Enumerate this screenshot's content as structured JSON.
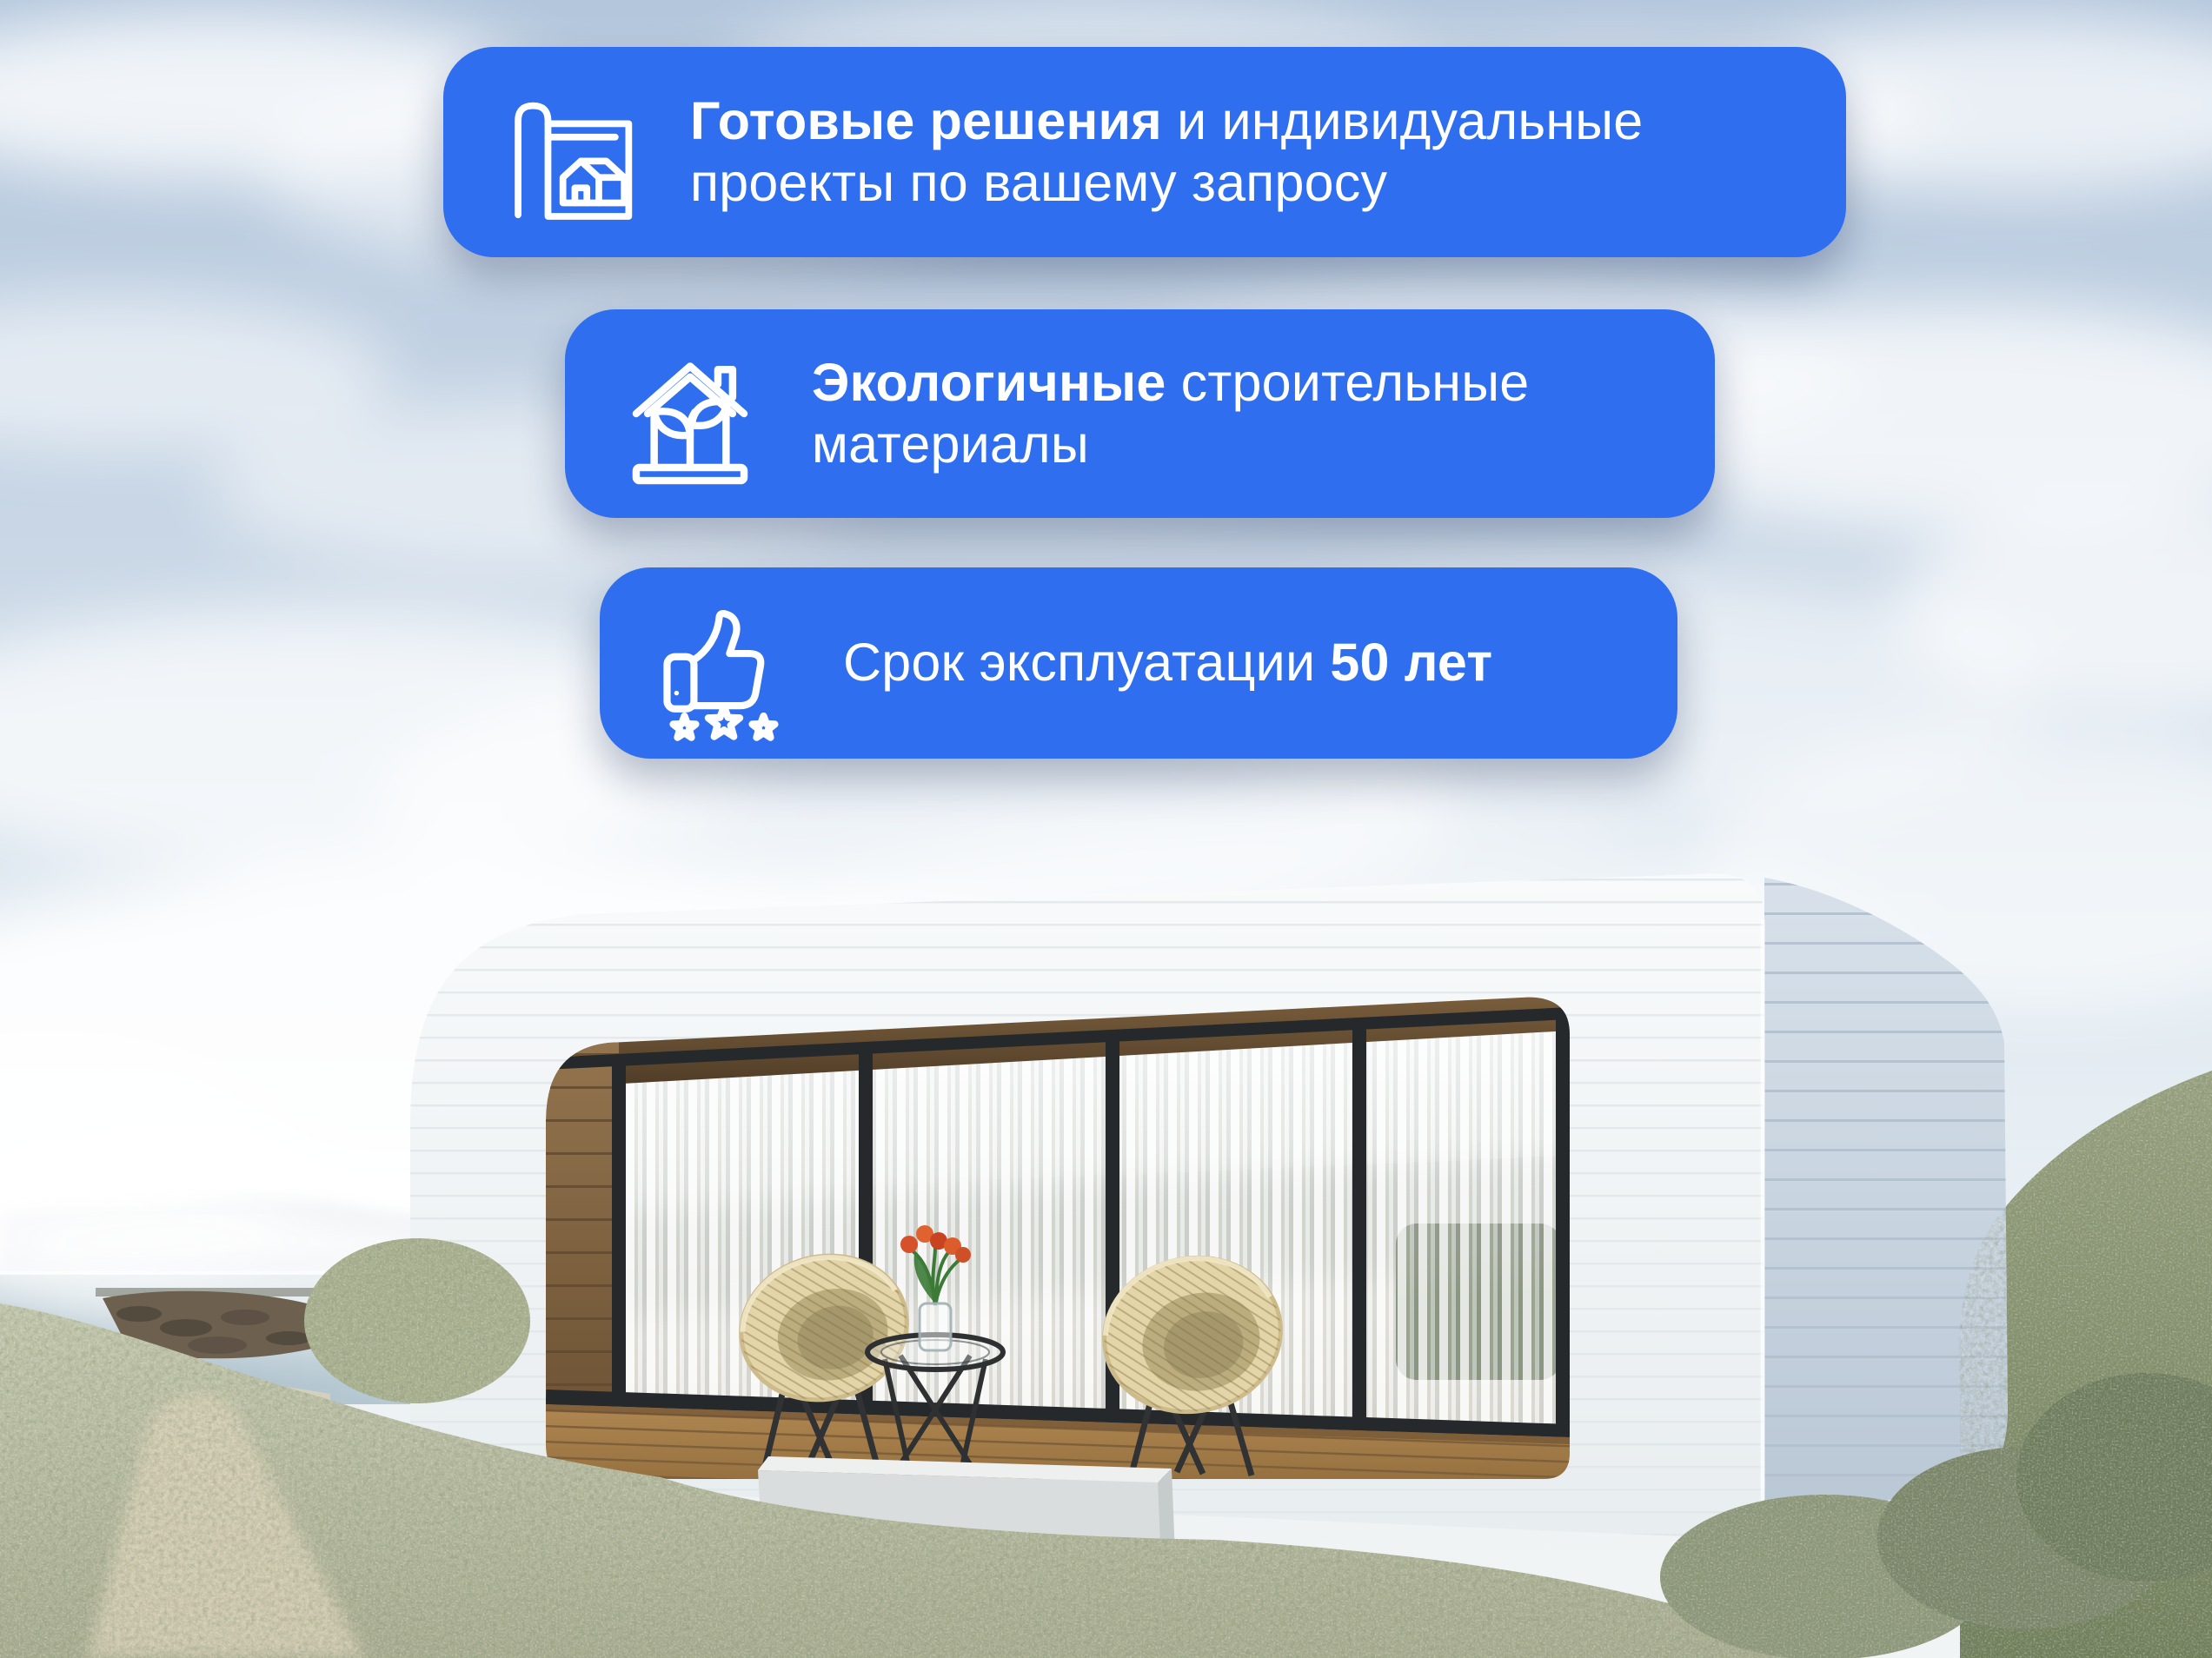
{
  "theme": {
    "badge_color": "#2E6EEF",
    "badge_text_color": "#FFFFFF"
  },
  "badges": [
    {
      "name": "ready-solutions",
      "icon": "blueprint-house-icon",
      "pre": "",
      "bold": "Готовые решения",
      "post": " и индивидуальные проекты по вашему запросу"
    },
    {
      "name": "eco-materials",
      "icon": "eco-house-icon",
      "pre": "",
      "bold": "Экологичные",
      "post": " строительные материалы"
    },
    {
      "name": "service-life",
      "icon": "thumbs-up-stars-icon",
      "pre": "Срок эксплуатации ",
      "bold": "50 лет",
      "post": ""
    }
  ]
}
